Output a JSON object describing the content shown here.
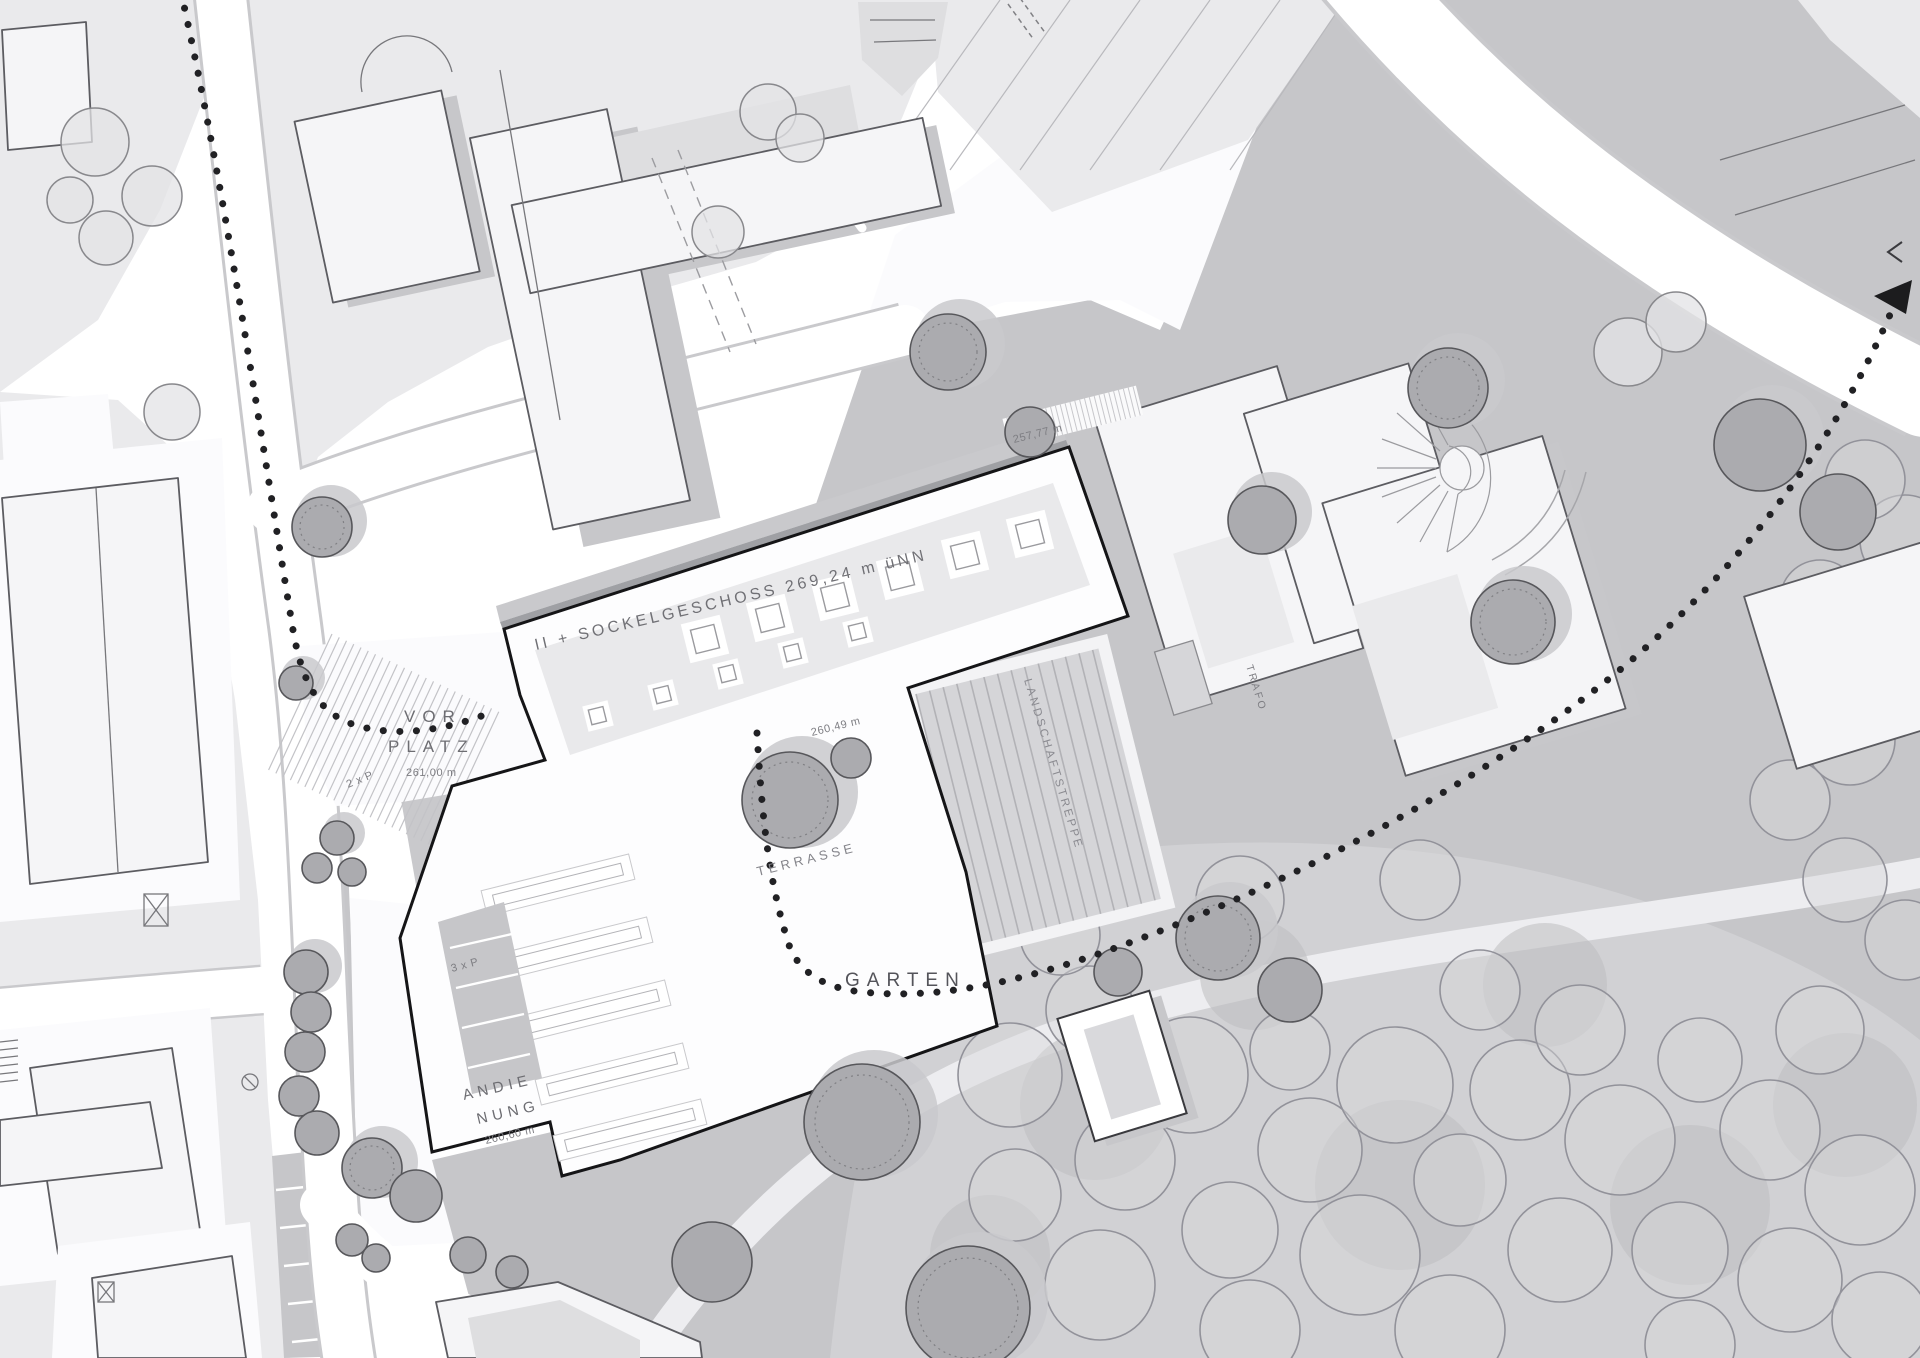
{
  "plan": {
    "type": "architectural-site-plan",
    "labels": {
      "roof": "II + SOCKELGESCHOSS 269,24 m üNN",
      "roof_edge_level": "257,77 m",
      "vorplatz_1": "VOR",
      "vorplatz_2": "PLATZ",
      "vorplatz_level": "261,00 m",
      "parking_2p": "2 x P",
      "parking_3p": "3 x P",
      "andienung_1": "ANDIE",
      "andienung_2": "NUNG",
      "andienung_level": "260,60 m",
      "garten": "GARTEN",
      "terrasse": "TERRASSE",
      "terrasse_level": "260,49 m",
      "treppe": "LANDSCHAFTSTREPPE",
      "trafo": "TRAFO"
    },
    "colors": {
      "outline": "#151517",
      "label": "#6e6e73",
      "lawn": "#c6c6c9",
      "forest-bg": "#d1d1d4",
      "block": "#eaeaec",
      "building": "#f5f5f7",
      "building-stroke": "#5c5c61",
      "main-fill": "#fdfdfe",
      "hatch": "#c5c5c9",
      "shadow": "#c7c7ca",
      "dots": "#212124"
    }
  }
}
